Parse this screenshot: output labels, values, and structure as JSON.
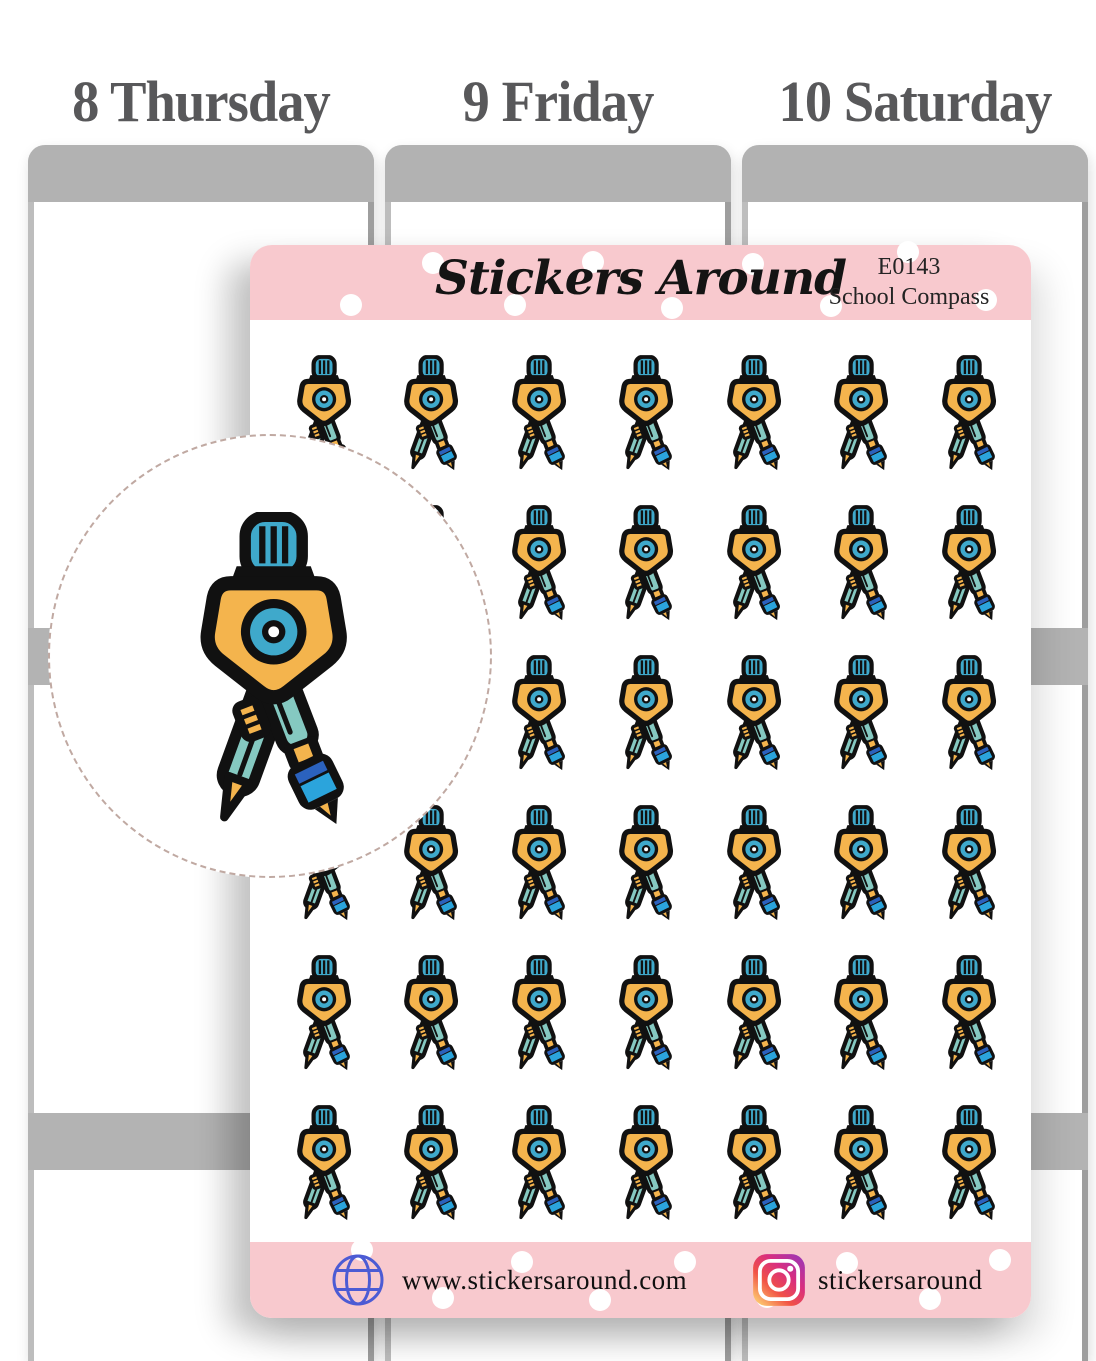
{
  "planner": {
    "days": [
      {
        "label": "8 Thursday"
      },
      {
        "label": "9 Friday"
      },
      {
        "label": "10 Saturday"
      }
    ]
  },
  "sheet": {
    "brand": "Stickers Around",
    "product_code": "E0143",
    "product_name": "School Compass",
    "grid": {
      "rows": 6,
      "cols": 7,
      "icon": "drafting-compass-icon"
    },
    "footer": {
      "website": "www.stickersaround.com",
      "instagram_handle": "stickersaround"
    }
  },
  "colors": {
    "pink_band": "#F8C9CE",
    "planner_gray": "#B2B2B2",
    "band_gray": "#B3B3B3",
    "day_text": "#58585A",
    "teal": "#85C9C1",
    "cyan": "#3FA9CB",
    "orange": "#F4B44D",
    "pen_blue": "#2BA4DC",
    "pen_navy": "#2B62BE",
    "ink": "#111111",
    "dash": "#C0A9A2",
    "globe_blue": "#4C5BD4"
  }
}
